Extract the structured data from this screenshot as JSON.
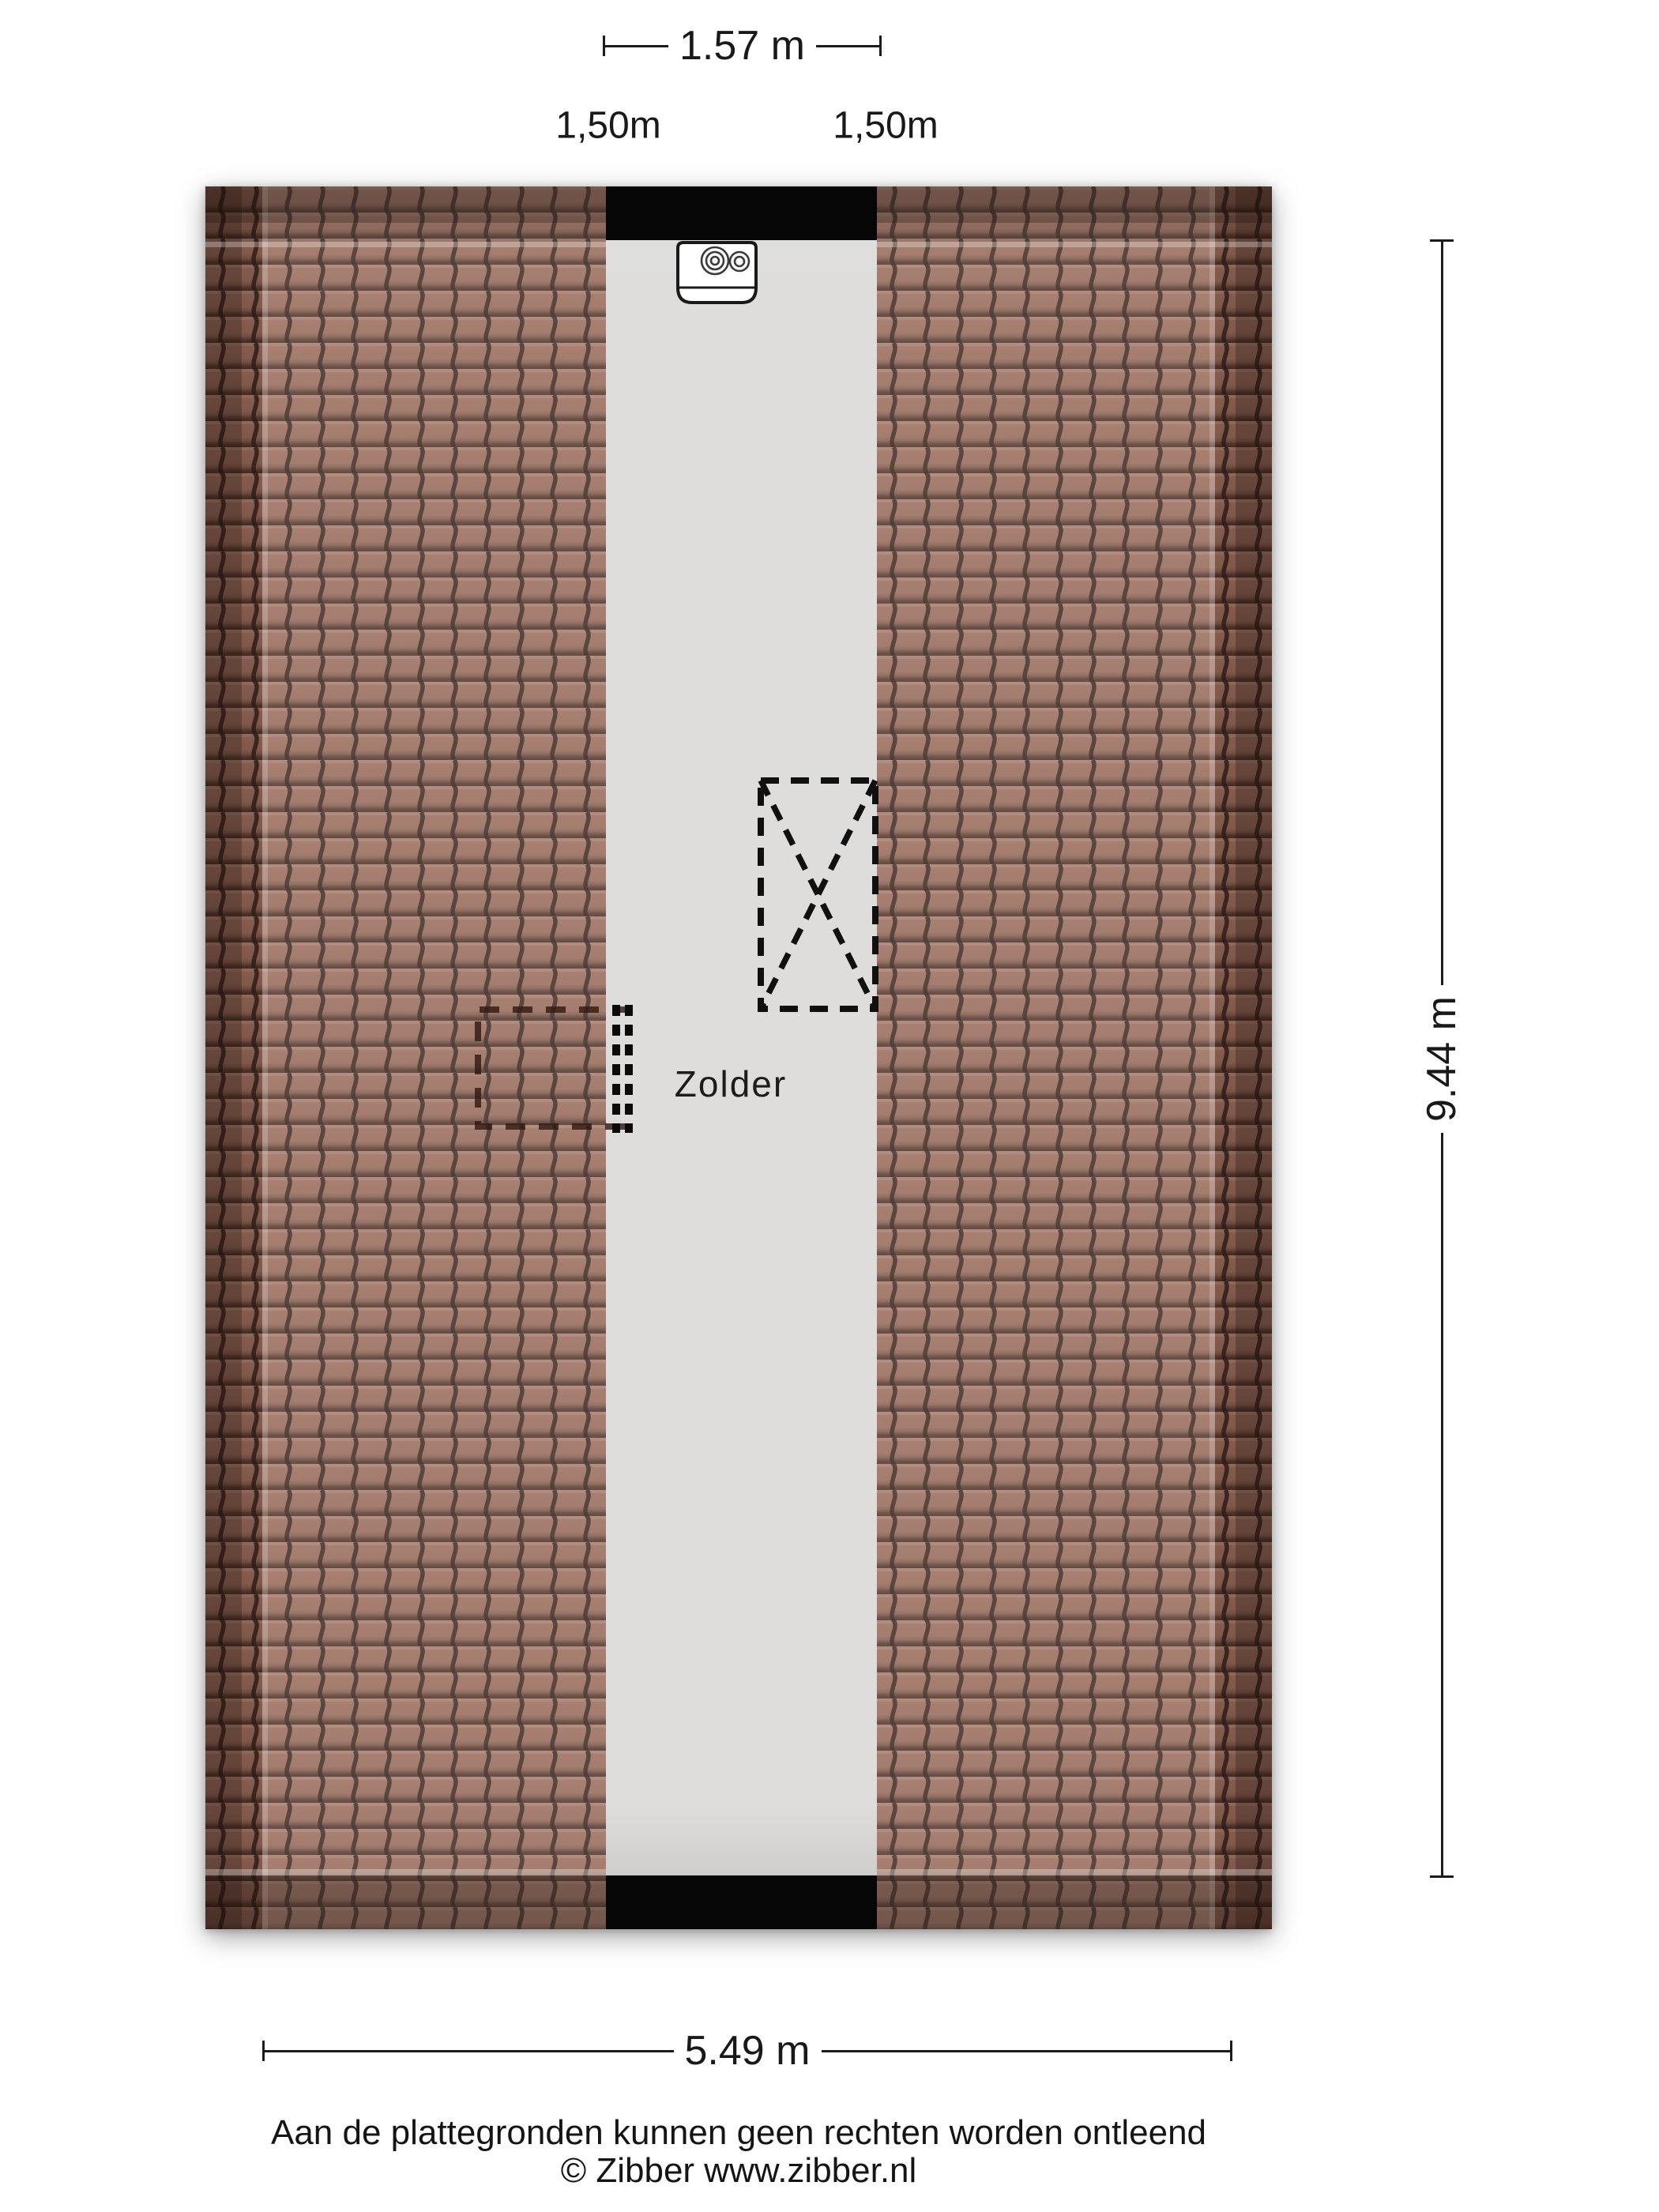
{
  "document": {
    "type": "attic floor plan",
    "floor_name": "Zolder"
  },
  "plan": {
    "room_label": "Zolder",
    "elements": {
      "ventilation_unit": "mechanical-ventilation-boiler-unit",
      "staircase_opening": "dashed rectangle with X (stair opening)",
      "roof_window_outline": "dashed rectangle on left roof slope"
    },
    "colors": {
      "roof_tile": "#9b6d5c",
      "roof_tile_line": "#31201a",
      "floor": "#dedddc",
      "wall_bar": "#060606",
      "dimension_text": "#191919"
    }
  },
  "dimensions": {
    "top_width": "1.57 m",
    "headroom_left": "1,50m",
    "headroom_right": "1,50m",
    "height_right": "9.44 m",
    "bottom_width": "5.49 m"
  },
  "footer": {
    "disclaimer": "Aan de plattegronden kunnen geen rechten worden ontleend",
    "copyright": "© Zibber www.zibber.nl"
  }
}
